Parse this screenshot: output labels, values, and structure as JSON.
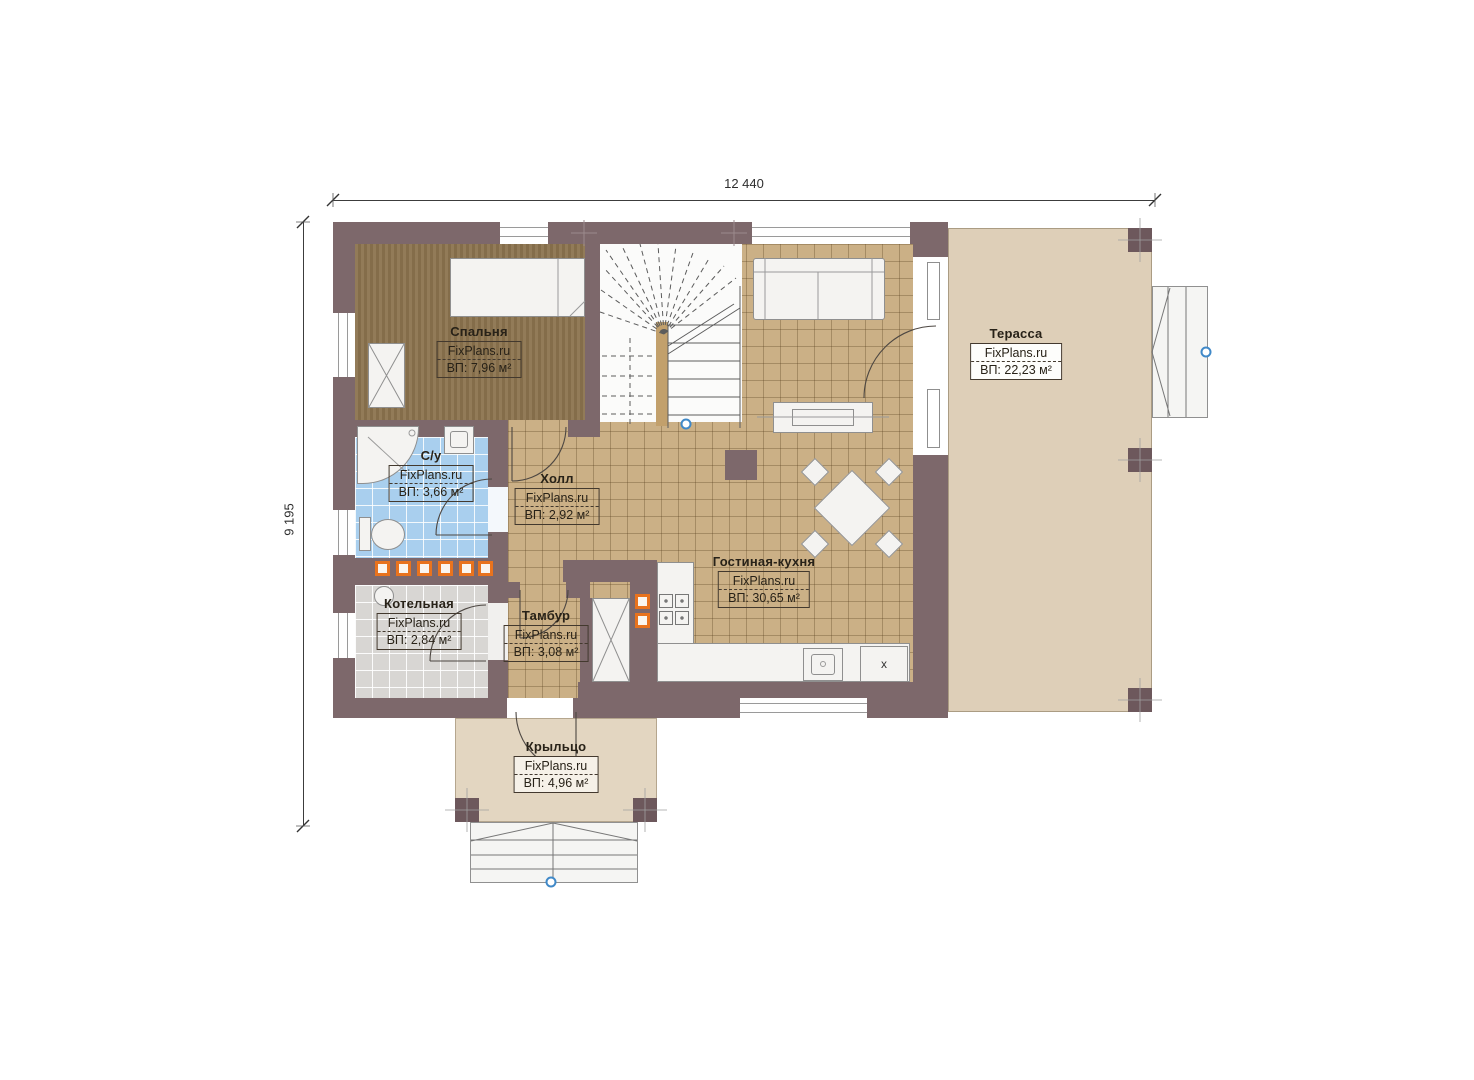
{
  "page": {
    "background": "#ffffff"
  },
  "dimensions": {
    "width_label": "12 440",
    "height_label": "9 195"
  },
  "watermark": "FixPlans.ru",
  "rooms": [
    {
      "id": "bedroom",
      "name": "Спальня",
      "watermark": "FixPlans.ru",
      "area": "ВП: 7,96 м²"
    },
    {
      "id": "bathroom",
      "name": "С/у",
      "watermark": "FixPlans.ru",
      "area": "ВП: 3,66 м²"
    },
    {
      "id": "hall",
      "name": "Холл",
      "watermark": "FixPlans.ru",
      "area": "ВП: 2,92 м²"
    },
    {
      "id": "boiler",
      "name": "Котельная",
      "watermark": "FixPlans.ru",
      "area": "ВП: 2,84 м²"
    },
    {
      "id": "vestibule",
      "name": "Тамбур",
      "watermark": "FixPlans.ru",
      "area": "ВП: 3,08 м²"
    },
    {
      "id": "living_kitchen",
      "name": "Гостиная-кухня",
      "watermark": "FixPlans.ru",
      "area": "ВП: 30,65 м²"
    },
    {
      "id": "terrace",
      "name": "Терасса",
      "watermark": "FixPlans.ru",
      "area": "ВП: 22,23 м²"
    },
    {
      "id": "porch",
      "name": "Крыльцо",
      "watermark": "FixPlans.ru",
      "area": "ВП: 4,96 м²"
    }
  ],
  "annotations": {
    "fridge_label": "x"
  },
  "colors": {
    "wall": "#7d686b",
    "floor_tile": "#cbb086",
    "floor_wood": "#8c744f",
    "floor_bath": "#a9cfee",
    "floor_boiler": "#d8d6d3",
    "terrace": "#decfb8",
    "porch": "#e3d6c1",
    "accent_orange": "#e8731e",
    "marker_blue": "#4089c8"
  }
}
